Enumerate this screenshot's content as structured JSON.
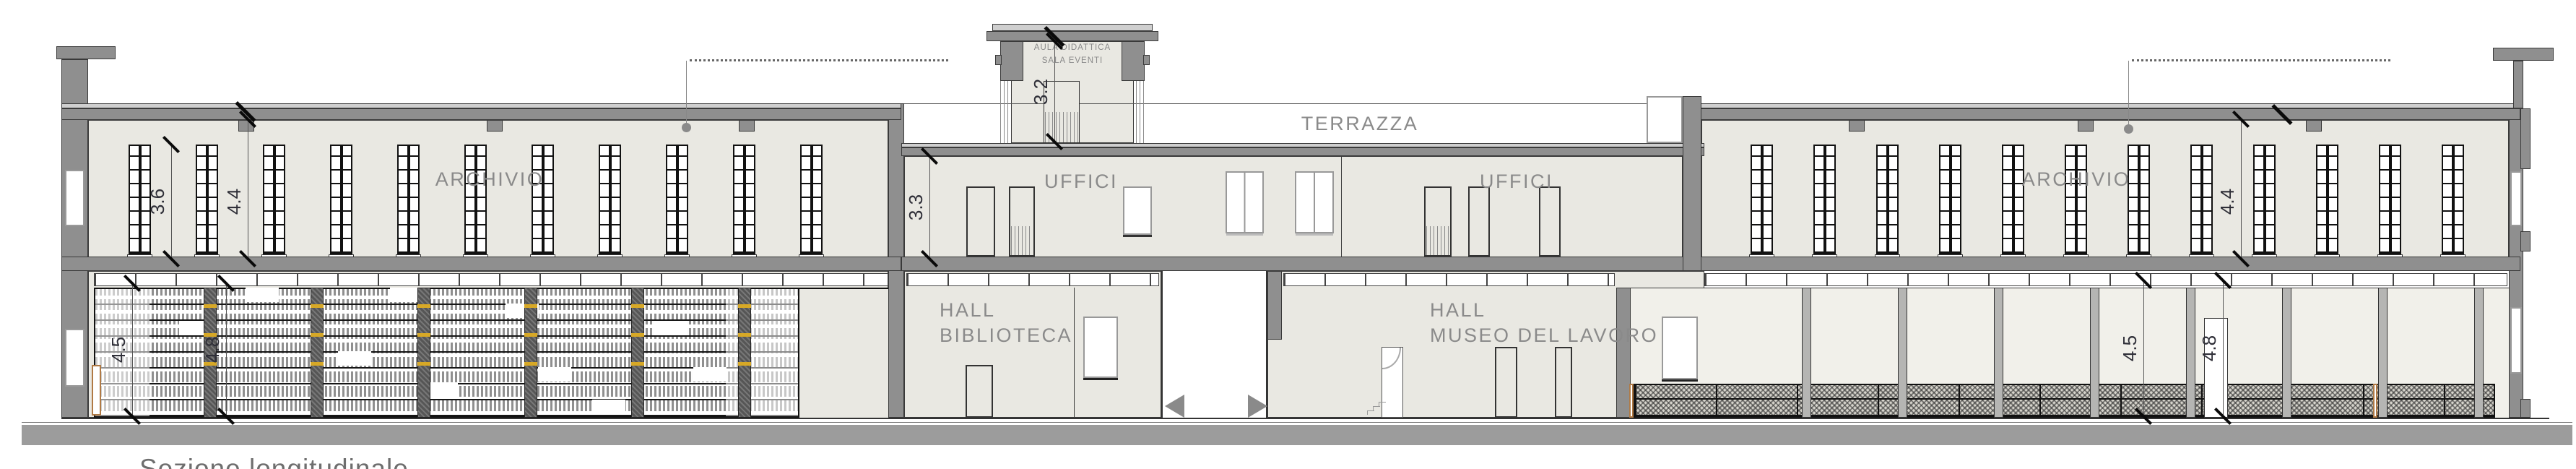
{
  "drawing": {
    "caption": "Sezione longitudinale",
    "rooms": {
      "archivio_left": "ARCHIVIO",
      "archivio_right": "ARCHIVIO",
      "uffici_left": "UFFICI",
      "uffici_right": "UFFICI",
      "terrazza": "TERRAZZA",
      "aula_line1": "AULA DIDATTICA",
      "aula_line2": "SALA EVENTI",
      "hall_biblioteca_line1": "HALL",
      "hall_biblioteca_line2": "BIBLIOTECA",
      "hall_museo_line1": "HALL",
      "hall_museo_line2": "MUSEO DEL LAVORO"
    },
    "dims": {
      "left_shelf_height": "3.6",
      "left_floor_height": "4.4",
      "uffici_height": "3.3",
      "tower_height": "3.2",
      "right_floor_height": "4.4",
      "left_bay_a": "4.5",
      "left_bay_b": "4.8",
      "right_bay_a": "4.5",
      "right_bay_b": "4.8"
    },
    "colors": {
      "section_gray": "#8f8f8f",
      "wall_fill": "#e9e8e2",
      "label_gray": "#8a8a8a",
      "dim_color": "#2f2f38",
      "ground_gray": "#9c9c9c",
      "accent_yellow": "#d7a826",
      "wood_tan": "#b07a45"
    }
  }
}
